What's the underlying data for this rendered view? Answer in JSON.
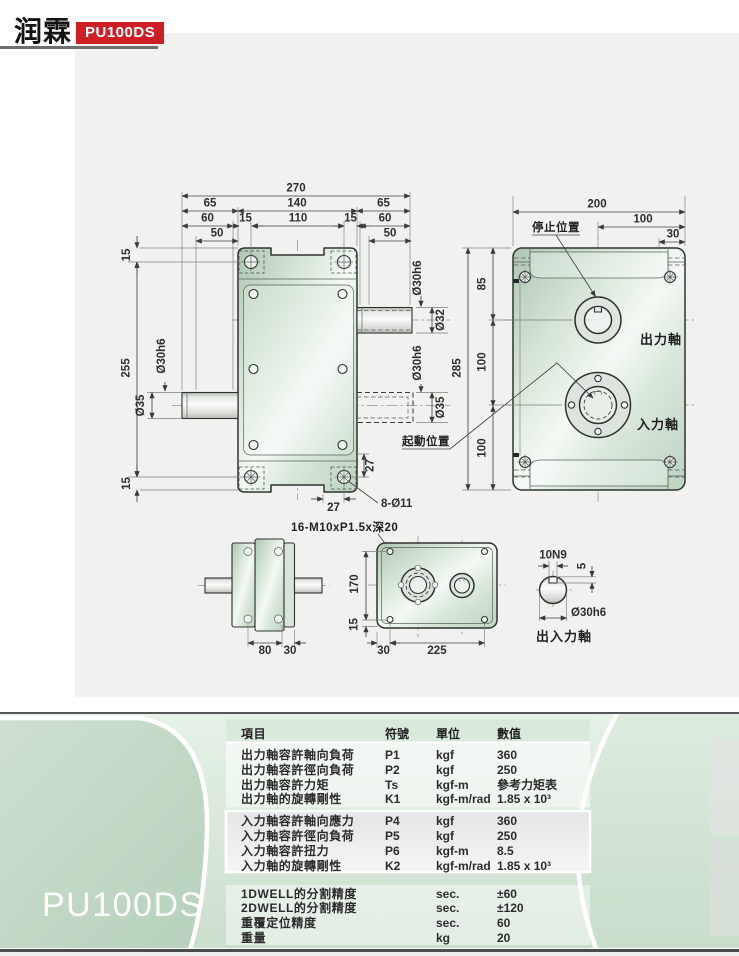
{
  "header": {
    "logo": "润霖",
    "model_badge": "PU100DS"
  },
  "colors": {
    "badge_red": "#ce1f27",
    "panel_green": "#cbdfce",
    "drawing_bg": "#f1f1ef"
  },
  "drawing": {
    "front": {
      "d270": "270",
      "d65l": "65",
      "d140": "140",
      "d65r": "65",
      "d60l": "60",
      "d15l": "15",
      "d110": "110",
      "d15r": "15",
      "d60r": "60",
      "d50l": "50",
      "d50r": "50",
      "d15t": "15",
      "d255": "255",
      "d15b": "15",
      "dia30L": "Ø30h6",
      "dia35L": "Ø35",
      "dia30RT": "Ø30h6",
      "dia32": "Ø32",
      "dia30RB": "Ø30h6",
      "dia35R": "Ø35",
      "d27h": "27",
      "d27v": "27",
      "holes": "8-Ø11",
      "tap": "16-M10xP1.5x深20"
    },
    "plan": {
      "d200": "200",
      "d100t": "100",
      "d30": "30",
      "d85": "85",
      "d285": "285",
      "d100a": "100",
      "d100b": "100",
      "stop": "停止位置",
      "start": "起動位置",
      "out": "出力軸",
      "in": "入力軸"
    },
    "side": {
      "d80": "80",
      "d30": "30"
    },
    "bottom": {
      "d170": "170",
      "d15": "15",
      "d30": "30",
      "d225": "225"
    },
    "detail": {
      "key": "10N9",
      "d5": "5",
      "dia": "Ø30h6",
      "label": "出入力軸"
    }
  },
  "spec": {
    "model": "PU100DS",
    "headers": {
      "item": "項目",
      "symbol": "符號",
      "unit": "單位",
      "value": "數值"
    },
    "groups": [
      {
        "rows": [
          {
            "item": "出力軸容許軸向負荷",
            "symbol": "P1",
            "unit": "kgf",
            "value": "360"
          },
          {
            "item": "出力軸容許徑向負荷",
            "symbol": "P2",
            "unit": "kgf",
            "value": "250"
          },
          {
            "item": "出力軸容許力矩",
            "symbol": "Ts",
            "unit": "kgf-m",
            "value": "參考力矩表"
          },
          {
            "item": "出力軸的旋轉剛性",
            "symbol": "K1",
            "unit": "kgf-m/rad",
            "value": "1.85 x 10³"
          }
        ]
      },
      {
        "rows": [
          {
            "item": "入力軸容許軸向應力",
            "symbol": "P4",
            "unit": "kgf",
            "value": "360"
          },
          {
            "item": "入力軸容許徑向負荷",
            "symbol": "P5",
            "unit": "kgf",
            "value": "250"
          },
          {
            "item": "入力軸容許扭力",
            "symbol": "P6",
            "unit": "kgf-m",
            "value": "8.5"
          },
          {
            "item": "入力軸的旋轉剛性",
            "symbol": "K2",
            "unit": "kgf-m/rad",
            "value": "1.85 x 10³"
          }
        ]
      },
      {
        "rows": [
          {
            "item": "1DWELL的分割精度",
            "symbol": "",
            "unit": "sec.",
            "value": "±60"
          },
          {
            "item": "2DWELL的分割精度",
            "symbol": "",
            "unit": "sec.",
            "value": "±120"
          },
          {
            "item": "重覆定位精度",
            "symbol": "",
            "unit": "sec.",
            "value": "60"
          },
          {
            "item": "重量",
            "symbol": "",
            "unit": "kg",
            "value": "20"
          }
        ]
      }
    ]
  }
}
